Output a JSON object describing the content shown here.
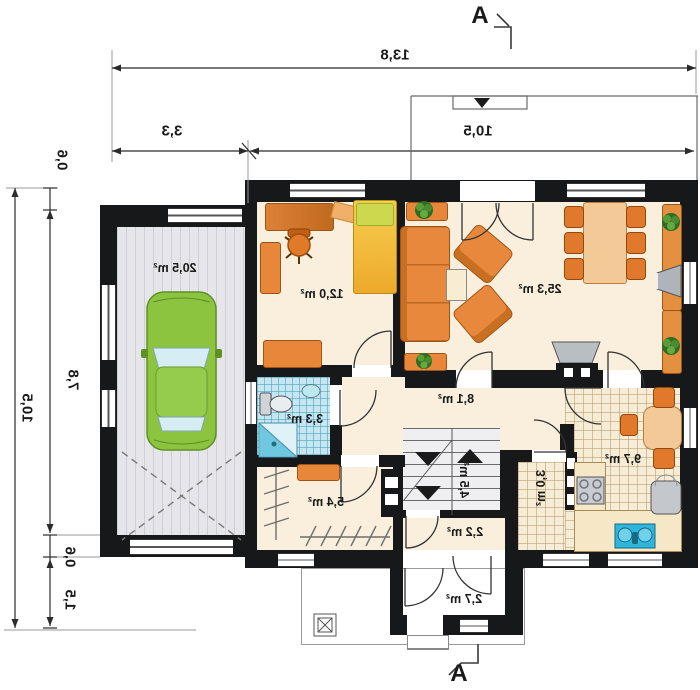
{
  "section_markers": {
    "top": "A",
    "bottom": "A"
  },
  "dimensions": {
    "top_total": "13,8",
    "garage_width": "3,3",
    "house_width": "10,5",
    "left_total": "10,5",
    "left_wall_top": "0,6",
    "left_garage_depth": "7,8",
    "left_wall_bottom": "0,6",
    "left_apron": "1,5"
  },
  "rooms": {
    "garage": "20,5 m²",
    "bedroom": "12,0 m²",
    "living_room": "25,3 m²",
    "bathroom": "3,3 m²",
    "hall": "8,1 m²",
    "stairs": "4,5 m²",
    "storage": "5,4 m²",
    "corridor": "2,2 m²",
    "entry": "2,7 m²",
    "pantry": "3,0 m²",
    "kitchen": "9,7 m²"
  },
  "colors": {
    "wall": "#17181a",
    "floor": "#f9efdc",
    "bath_tile": "#c5e7f1",
    "furniture_orange": "#e8873a",
    "bed_yellow": "#f2bc3d",
    "car_green": "#8cc440",
    "sink_blue": "#2fb6dc"
  }
}
